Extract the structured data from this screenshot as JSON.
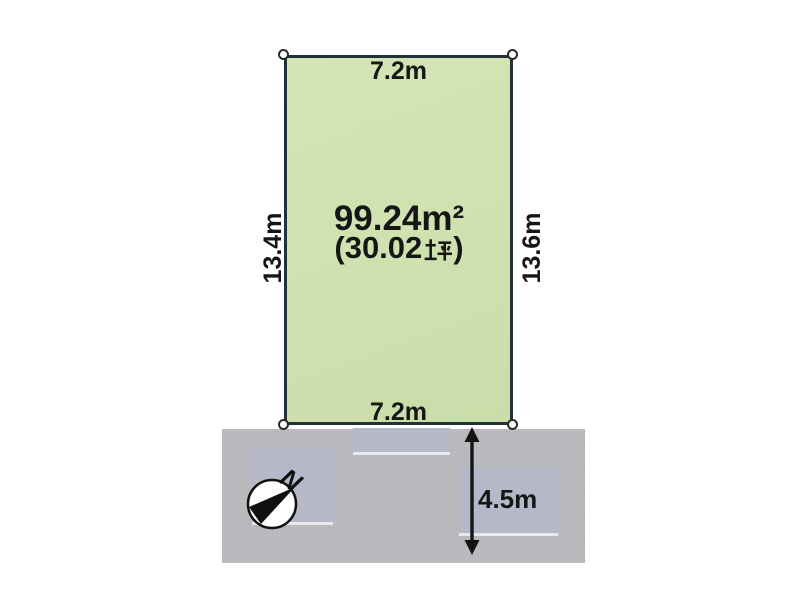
{
  "plot": {
    "area_label": "99.24m²",
    "area_tsubo_label": "(30.02坪)",
    "area_tsubo_prefix": "(30.02",
    "area_tsubo_suffix": ")",
    "dim_top": "7.2m",
    "dim_bottom": "7.2m",
    "dim_left": "13.4m",
    "dim_right": "13.6m"
  },
  "road": {
    "width_label": "4.5m"
  },
  "compass": {
    "north_label": "N"
  },
  "colors": {
    "canvas": "#ffffff",
    "plot_fill": "#cfe1af",
    "plot_border": "#20323a",
    "road_fill": "#bcbbc0",
    "building_fill": "#b5b8c8",
    "label_color": "#161616"
  }
}
